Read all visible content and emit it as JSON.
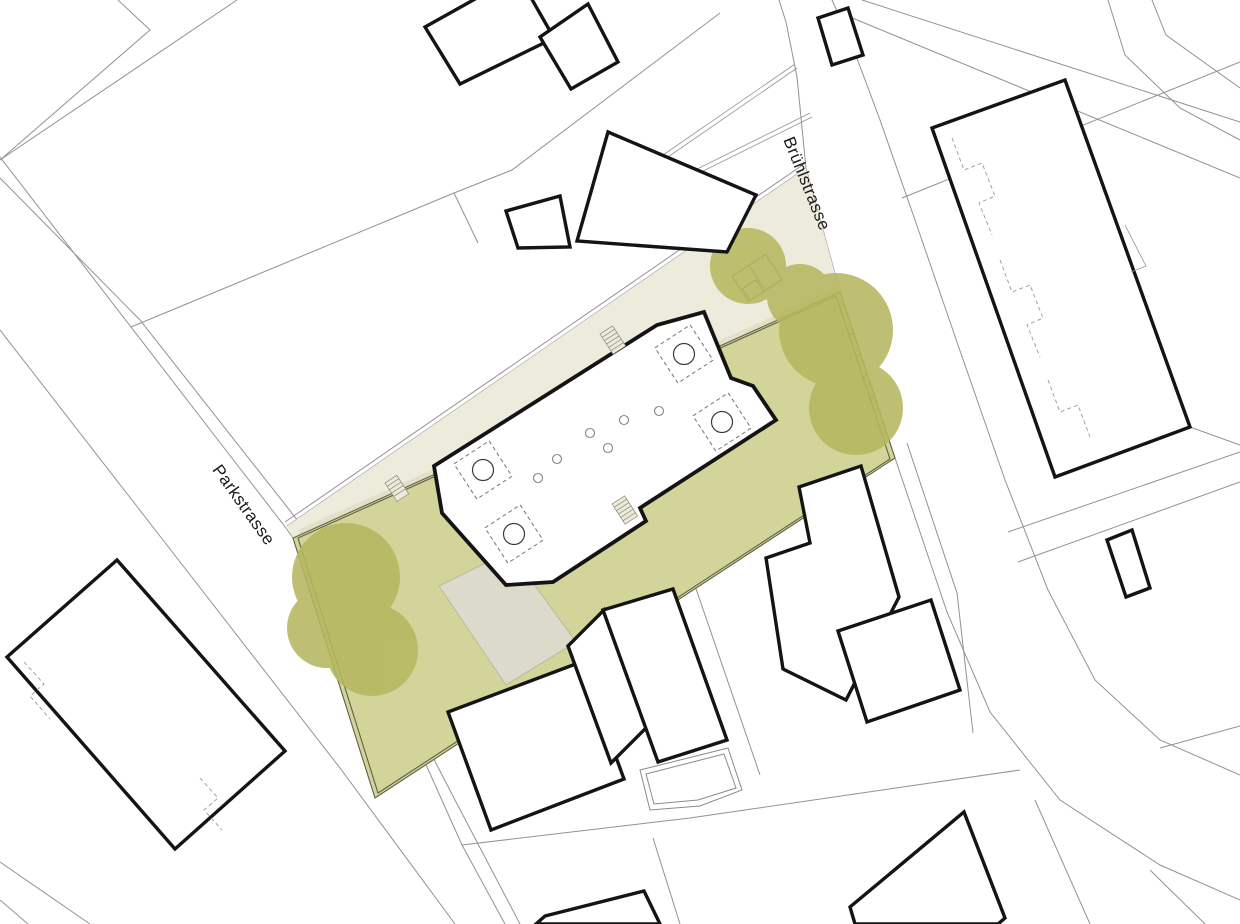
{
  "map": {
    "title": "architectural-site-plan",
    "streets": [
      {
        "name": "Brühlstrasse"
      },
      {
        "name": "Parkstrasse"
      }
    ],
    "site": {
      "features": [
        "lawn",
        "footpath",
        "terrace",
        "tree-canopy",
        "new-building",
        "entry-stairs",
        "courtyard-skylights",
        "columns",
        "garden-pavilion",
        "site-boundary-fence"
      ]
    },
    "palette": {
      "bg": "#ffffff",
      "lawn": "#d3d49a",
      "tree": "#b6b75f",
      "path": "#edebdc",
      "band": "#e2e0c8",
      "terrace": "#dcdacb",
      "outline": "#141414",
      "parcel": "#929292",
      "boundary": "#5f5f45",
      "label": "#1a1a1a"
    }
  }
}
